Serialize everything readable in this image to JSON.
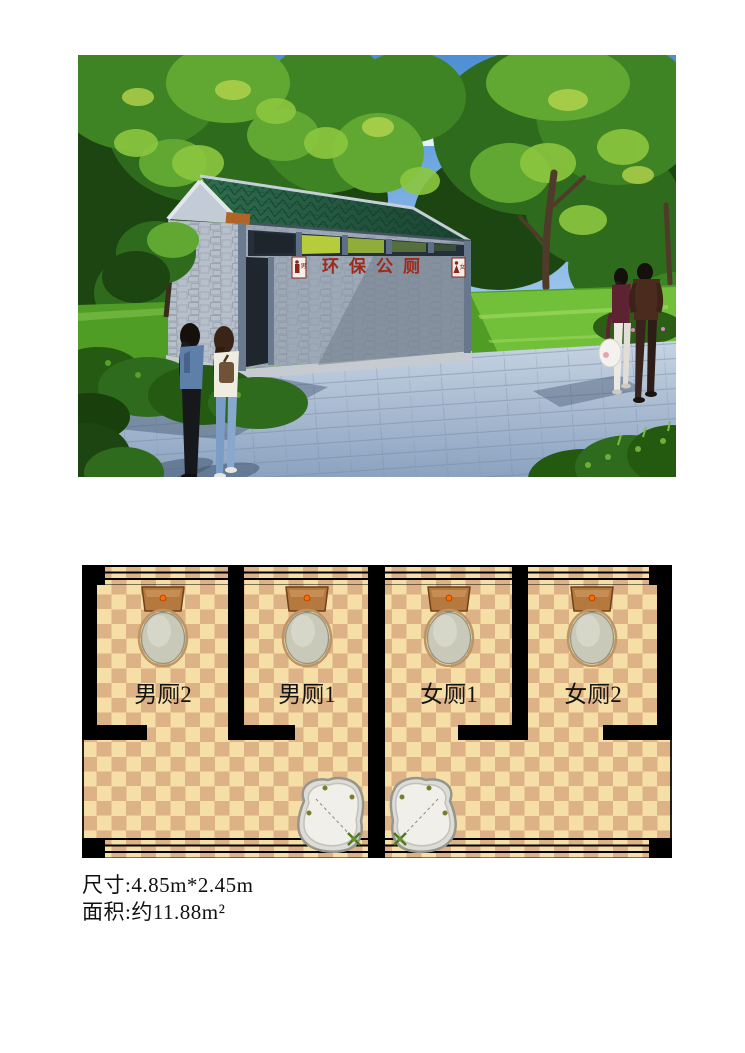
{
  "document": {
    "background": "#ffffff",
    "description": "环保公厕 效果图与平面图"
  },
  "photo": {
    "building_sign": "环保公厕",
    "plaque_male": "男",
    "plaque_female": "女",
    "colors": {
      "sky": "#7db4e8",
      "foliage": "#3f8424",
      "grass": "#5aa62c",
      "roof": "#1f5038",
      "wall": "#9da9b7",
      "paving": "#a9bdd3",
      "sign_red": "#9e2a1a"
    }
  },
  "floor_plan": {
    "stalls": [
      {
        "label": "男厕2"
      },
      {
        "label": "男厕1"
      },
      {
        "label": "女厕1"
      },
      {
        "label": "女厕2"
      }
    ],
    "fixtures": {
      "toilets": 4,
      "washbasins": 2
    },
    "colors": {
      "floor_light": "#f6dfa6",
      "floor_dark": "#dcb286",
      "wall": "#000000"
    }
  },
  "specs": {
    "size_line": "尺寸:4.85m*2.45m",
    "area_line": "面积:约11.88m²"
  }
}
